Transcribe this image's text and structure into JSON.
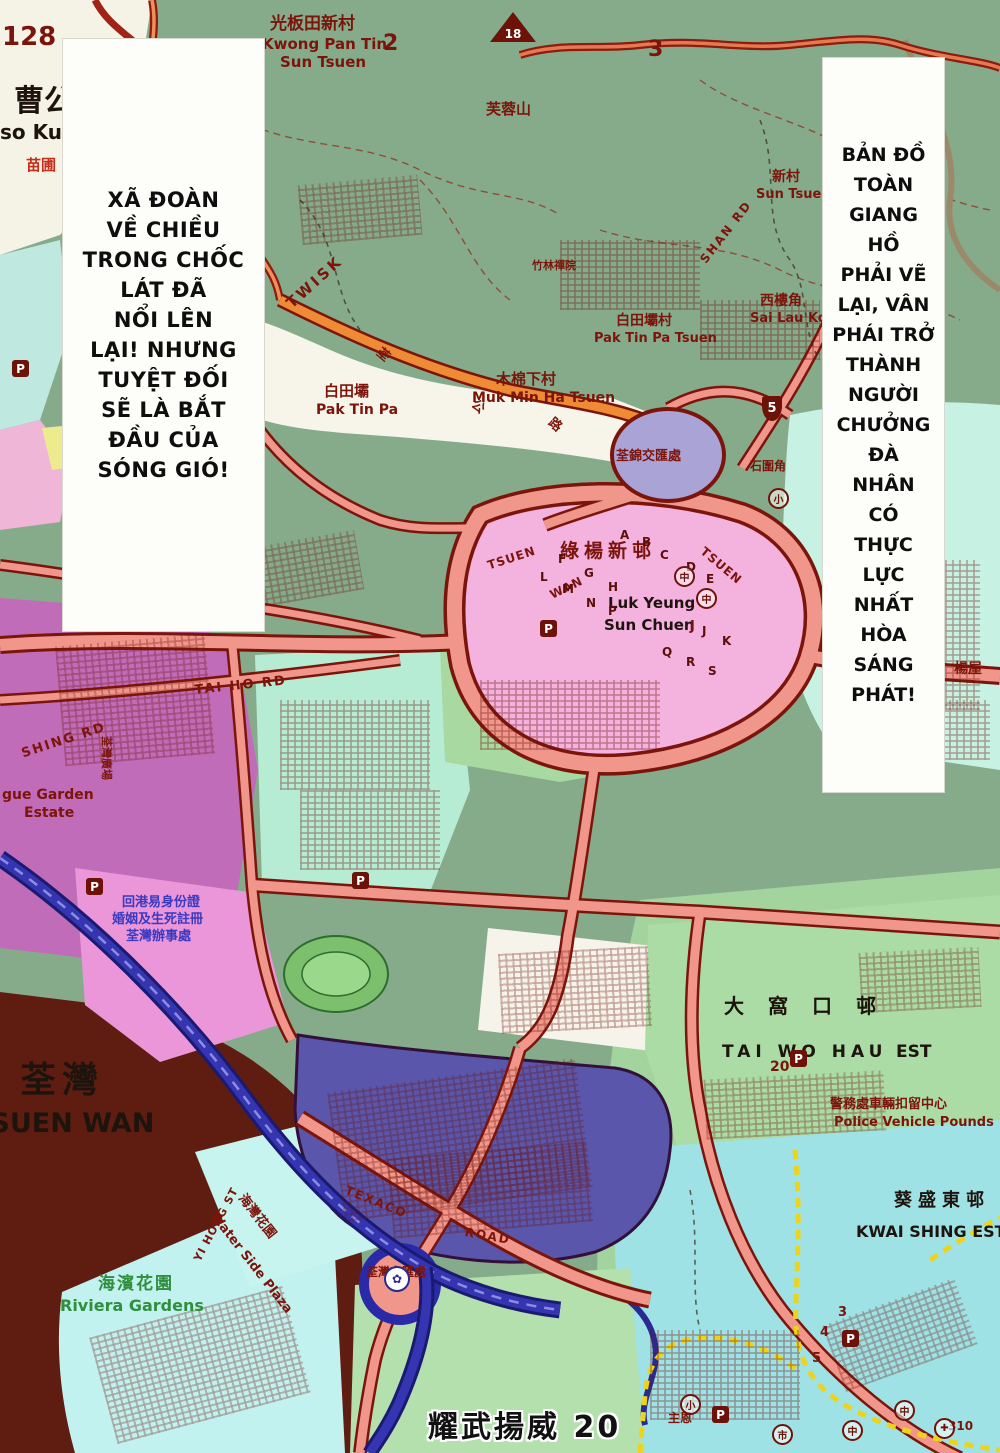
{
  "page": {
    "footer": "耀武揚威 20"
  },
  "balloons": {
    "left_text": "XÃ ĐOÀN\nVỀ CHIỀU\nTRONG CHỐC\nLÁT ĐÃ\nNỔI LÊN\nLẠI! NHƯNG\nTUYỆT ĐỐI\nSẼ LÀ BẮT\nĐẦU CỦA\nSÓNG GIÓ!",
    "right_text": "BẢN ĐỒ\nTOÀN\nGIANG\nHỒ\nPHẢI VẼ\nLẠI, VÂN\nPHÁI TRỞ\nTHÀNH\nNGƯỜI\nCHƯỞNG\nĐÀ\nNHÂN\nCÓ\nTHỰC\nLỰC\nNHẤT\nHÒA\nSÁNG\nPHÁT!"
  },
  "map": {
    "colors": {
      "hill_green": "#86ab8b",
      "road_fill": "#f0968b",
      "road_casing": "#7b150b",
      "orange_road": "#ef8a35",
      "white_area": "#f7f4ea",
      "cyan_block": "#c2ecdf",
      "pink_estate": "#f4b2de",
      "magenta_block": "#c06cb8",
      "indigo_estate": "#5956ab",
      "harbour_water": "#5f1d11",
      "riviera_cyan": "#c2f2f0",
      "kwai_cyan": "#9fe2e6",
      "green_block": "#aadca6",
      "highway_blue": "#3535b2",
      "boundary_yellow": "#ecd41c"
    },
    "labels": [
      {
        "t": "128",
        "x": 2,
        "y": 24,
        "fs": 26,
        "n": "grid-number-128"
      },
      {
        "t": "曹公",
        "x": 14,
        "y": 86,
        "fs": 30,
        "c": "bk",
        "n": "label-tso-kung-zh"
      },
      {
        "t": "so Kung",
        "x": 0,
        "y": 122,
        "fs": 20,
        "c": "bk",
        "n": "label-tso-kung-en"
      },
      {
        "t": "苗圃",
        "x": 26,
        "y": 158,
        "fs": 15,
        "c": "rd",
        "n": "label-nursery"
      },
      {
        "t": "光板田新村",
        "x": 270,
        "y": 16,
        "fs": 17,
        "n": "label-kwong-pan-tin-zh"
      },
      {
        "t": "Kwong Pan Tin",
        "x": 262,
        "y": 37,
        "fs": 15,
        "n": "label-kwong-pan-tin-en"
      },
      {
        "t": "Sun Tsuen",
        "x": 280,
        "y": 55,
        "fs": 15,
        "n": "label-kwong-pan-tin-en2"
      },
      {
        "t": "2",
        "x": 383,
        "y": 32,
        "fs": 22,
        "n": "grid-number-2"
      },
      {
        "t": "3",
        "x": 648,
        "y": 38,
        "fs": 22,
        "n": "grid-number-3"
      },
      {
        "t": "芙蓉山",
        "x": 486,
        "y": 102,
        "fs": 15,
        "n": "label-fu-yung-shan"
      },
      {
        "t": "新村",
        "x": 772,
        "y": 170,
        "fs": 14,
        "n": "label-sun-tsuen-zh"
      },
      {
        "t": "Sun Tsuen",
        "x": 756,
        "y": 188,
        "fs": 13,
        "n": "label-sun-tsuen-en"
      },
      {
        "t": "西樓角",
        "x": 760,
        "y": 294,
        "fs": 14,
        "n": "label-sai-lau-kok-zh"
      },
      {
        "t": "Sai Lau Kok",
        "x": 750,
        "y": 312,
        "fs": 13,
        "n": "label-sai-lau-kok-en"
      },
      {
        "t": "白田壩村",
        "x": 616,
        "y": 314,
        "fs": 14,
        "n": "label-pak-tin-pa-tsuen-zh"
      },
      {
        "t": "Pak Tin Pa Tsuen",
        "x": 594,
        "y": 332,
        "fs": 13,
        "n": "label-pak-tin-pa-tsuen-en"
      },
      {
        "t": "TWISK",
        "x": 284,
        "y": 300,
        "fs": 15,
        "rot": -42,
        "ls": 3,
        "n": "label-route-twisk"
      },
      {
        "t": "白田壩",
        "x": 324,
        "y": 384,
        "fs": 15,
        "n": "label-pak-tin-pa-zh"
      },
      {
        "t": "Pak Tin Pa",
        "x": 316,
        "y": 403,
        "fs": 14,
        "n": "label-pak-tin-pa-en"
      },
      {
        "t": "木棉下村",
        "x": 496,
        "y": 372,
        "fs": 15,
        "n": "label-muk-min-ha-zh"
      },
      {
        "t": "Muk Min Ha Tsuen",
        "x": 472,
        "y": 391,
        "fs": 14,
        "n": "label-muk-min-ha-en"
      },
      {
        "t": "竹林禪院",
        "x": 532,
        "y": 260,
        "fs": 11
      },
      {
        "t": "荃錦交匯處",
        "x": 616,
        "y": 450,
        "fs": 13,
        "n": "label-tsuen-kam-interchange"
      },
      {
        "t": "荃",
        "x": 382,
        "y": 346,
        "fs": 13,
        "rot": 40
      },
      {
        "t": "公",
        "x": 477,
        "y": 398,
        "fs": 13,
        "rot": 40
      },
      {
        "t": "路",
        "x": 554,
        "y": 416,
        "fs": 13,
        "rot": 40
      },
      {
        "t": "綠楊新邨",
        "x": 560,
        "y": 542,
        "fs": 19,
        "ls": 5,
        "n": "label-luk-yeung-zh"
      },
      {
        "t": "Luk Yeung",
        "x": 608,
        "y": 596,
        "fs": 15,
        "c": "bk",
        "n": "label-luk-yeung-en"
      },
      {
        "t": "Sun Chuen",
        "x": 604,
        "y": 618,
        "fs": 15,
        "c": "bk"
      },
      {
        "t": "J",
        "x": 690,
        "y": 620,
        "fs": 13
      },
      {
        "t": "TSUEN",
        "x": 486,
        "y": 560,
        "fs": 12,
        "rot": -18,
        "ls": 1
      },
      {
        "t": "WAN",
        "x": 548,
        "y": 590,
        "fs": 12,
        "rot": -26,
        "ls": 1
      },
      {
        "t": "TSUEN",
        "x": 706,
        "y": 545,
        "fs": 12,
        "rot": 40,
        "ls": 1
      },
      {
        "t": "石圍角",
        "x": 750,
        "y": 460,
        "fs": 12
      },
      {
        "t": "楊屋",
        "x": 954,
        "y": 662,
        "fs": 14
      },
      {
        "t": "大窩口邨",
        "x": 724,
        "y": 996,
        "fs": 20,
        "ls": 24,
        "c": "bk",
        "n": "label-tai-wo-hau-zh"
      },
      {
        "t": "TAI WO HAU",
        "x": 722,
        "y": 1044,
        "fs": 17,
        "ls": 5,
        "c": "bk",
        "n": "label-tai-wo-hau-en"
      },
      {
        "t": "EST",
        "x": 896,
        "y": 1044,
        "fs": 17,
        "c": "bk"
      },
      {
        "t": "20",
        "x": 770,
        "y": 1060,
        "fs": 14
      },
      {
        "t": "警務處車輛扣留中心",
        "x": 830,
        "y": 1098,
        "fs": 13,
        "n": "label-police-pounds-zh"
      },
      {
        "t": "Police Vehicle Pounds",
        "x": 834,
        "y": 1116,
        "fs": 13,
        "n": "label-police-pounds-en"
      },
      {
        "t": "葵盛東邨",
        "x": 894,
        "y": 1192,
        "fs": 18,
        "ls": 6,
        "c": "bk",
        "n": "label-kwai-shing-zh"
      },
      {
        "t": "KWAI SHING EST",
        "x": 856,
        "y": 1224,
        "fs": 16,
        "c": "bk",
        "n": "label-kwai-shing-en"
      },
      {
        "t": "荃灣",
        "x": 20,
        "y": 1062,
        "fs": 36,
        "ls": 6,
        "c": "bk",
        "n": "label-tsuen-wan-zh"
      },
      {
        "t": "TSUEN WAN",
        "x": -28,
        "y": 1110,
        "fs": 27,
        "c": "bk",
        "n": "label-tsuen-wan-en"
      },
      {
        "t": "海濱花園",
        "x": 98,
        "y": 1276,
        "fs": 17,
        "ls": 2,
        "c": "gr",
        "n": "label-riviera-zh"
      },
      {
        "t": "Riviera Gardens",
        "x": 60,
        "y": 1298,
        "fs": 16,
        "c": "gr",
        "n": "label-riviera-en"
      },
      {
        "t": "海灣花園",
        "x": 246,
        "y": 1192,
        "fs": 13,
        "rot": 52,
        "n": "label-water-side-zh"
      },
      {
        "t": "Water Side Plaza",
        "x": 218,
        "y": 1210,
        "fs": 13,
        "rot": 52,
        "n": "label-water-side-en"
      },
      {
        "t": "TEXACO",
        "x": 348,
        "y": 1184,
        "fs": 12,
        "rot": 22,
        "ls": 2,
        "n": "label-texaco-road"
      },
      {
        "t": "ROAD",
        "x": 466,
        "y": 1226,
        "fs": 12,
        "rot": 10,
        "ls": 2
      },
      {
        "t": "荃灣交匯處",
        "x": 366,
        "y": 1266,
        "fs": 12,
        "n": "label-tsuen-wan-interchange"
      },
      {
        "t": "YI HONG ST",
        "x": 192,
        "y": 1258,
        "fs": 11,
        "rot": -62,
        "ls": 1
      },
      {
        "t": "SHAN RD",
        "x": 698,
        "y": 258,
        "fs": 12,
        "rot": -52,
        "ls": 2
      },
      {
        "t": "SHING RD",
        "x": 20,
        "y": 748,
        "fs": 13,
        "rot": -18,
        "ls": 2
      },
      {
        "t": "gue Garden",
        "x": 2,
        "y": 788,
        "fs": 14
      },
      {
        "t": "Estate",
        "x": 24,
        "y": 806,
        "fs": 14
      },
      {
        "t": "荃灣廣場",
        "x": 112,
        "y": 736,
        "fs": 11,
        "rot": 90
      },
      {
        "t": "回港易身份證",
        "x": 122,
        "y": 896,
        "fs": 13,
        "c": "bl",
        "n": "label-registry-office"
      },
      {
        "t": "婚姻及生死註冊",
        "x": 112,
        "y": 913,
        "fs": 13,
        "c": "bl"
      },
      {
        "t": "荃灣辦事處",
        "x": 126,
        "y": 930,
        "fs": 13,
        "c": "bl"
      },
      {
        "t": "TAI HO RD",
        "x": 194,
        "y": 684,
        "fs": 13,
        "rot": -6,
        "ls": 2
      },
      {
        "t": "主恩",
        "x": 668,
        "y": 1412,
        "fs": 12
      },
      {
        "t": "310",
        "x": 948,
        "y": 1420,
        "fs": 12
      },
      {
        "t": "3",
        "x": 838,
        "y": 1306,
        "fs": 13
      },
      {
        "t": "4",
        "x": 820,
        "y": 1326,
        "fs": 13
      },
      {
        "t": "5",
        "x": 812,
        "y": 1352,
        "fs": 13
      }
    ],
    "scatter_letters": [
      {
        "t": "A",
        "x": 620,
        "y": 528
      },
      {
        "t": "B",
        "x": 642,
        "y": 535
      },
      {
        "t": "C",
        "x": 660,
        "y": 548
      },
      {
        "t": "D",
        "x": 686,
        "y": 560
      },
      {
        "t": "E",
        "x": 706,
        "y": 572
      },
      {
        "t": "F",
        "x": 558,
        "y": 552
      },
      {
        "t": "G",
        "x": 584,
        "y": 566
      },
      {
        "t": "H",
        "x": 608,
        "y": 580
      },
      {
        "t": "L",
        "x": 540,
        "y": 570
      },
      {
        "t": "M",
        "x": 562,
        "y": 582
      },
      {
        "t": "N",
        "x": 586,
        "y": 596
      },
      {
        "t": "P",
        "x": 608,
        "y": 604
      },
      {
        "t": "J",
        "x": 702,
        "y": 624
      },
      {
        "t": "K",
        "x": 722,
        "y": 634
      },
      {
        "t": "Q",
        "x": 662,
        "y": 645
      },
      {
        "t": "R",
        "x": 686,
        "y": 655
      },
      {
        "t": "S",
        "x": 708,
        "y": 664
      }
    ],
    "markers": [
      {
        "type": "peak",
        "t": "18",
        "x": 490,
        "y": 12,
        "n": "peak-18-marker"
      },
      {
        "type": "shield",
        "t": "5",
        "x": 762,
        "y": 396,
        "n": "route-5-shield"
      },
      {
        "type": "parking",
        "t": "P",
        "x": 12,
        "y": 360
      },
      {
        "type": "parking",
        "t": "P",
        "x": 86,
        "y": 878
      },
      {
        "type": "parking",
        "t": "P",
        "x": 540,
        "y": 620
      },
      {
        "type": "parking",
        "t": "P",
        "x": 352,
        "y": 872
      },
      {
        "type": "parking",
        "t": "P",
        "x": 790,
        "y": 1050
      },
      {
        "type": "parking",
        "t": "P",
        "x": 842,
        "y": 1330
      },
      {
        "type": "parking",
        "t": "P",
        "x": 712,
        "y": 1406
      },
      {
        "type": "circle",
        "t": "小",
        "x": 680,
        "y": 1394
      },
      {
        "type": "circle",
        "t": "小",
        "x": 768,
        "y": 488
      },
      {
        "type": "circle",
        "t": "中",
        "x": 674,
        "y": 566
      },
      {
        "type": "circle",
        "t": "中",
        "x": 696,
        "y": 588
      },
      {
        "type": "circle",
        "t": "中",
        "x": 894,
        "y": 1400
      },
      {
        "type": "circle",
        "t": "中",
        "x": 842,
        "y": 1420
      },
      {
        "type": "circle",
        "t": "市",
        "x": 772,
        "y": 1424
      },
      {
        "type": "circle",
        "t": "✚",
        "x": 934,
        "y": 1418
      },
      {
        "type": "flower",
        "t": "✿",
        "x": 384,
        "y": 1266,
        "n": "roundabout-icon"
      }
    ]
  }
}
